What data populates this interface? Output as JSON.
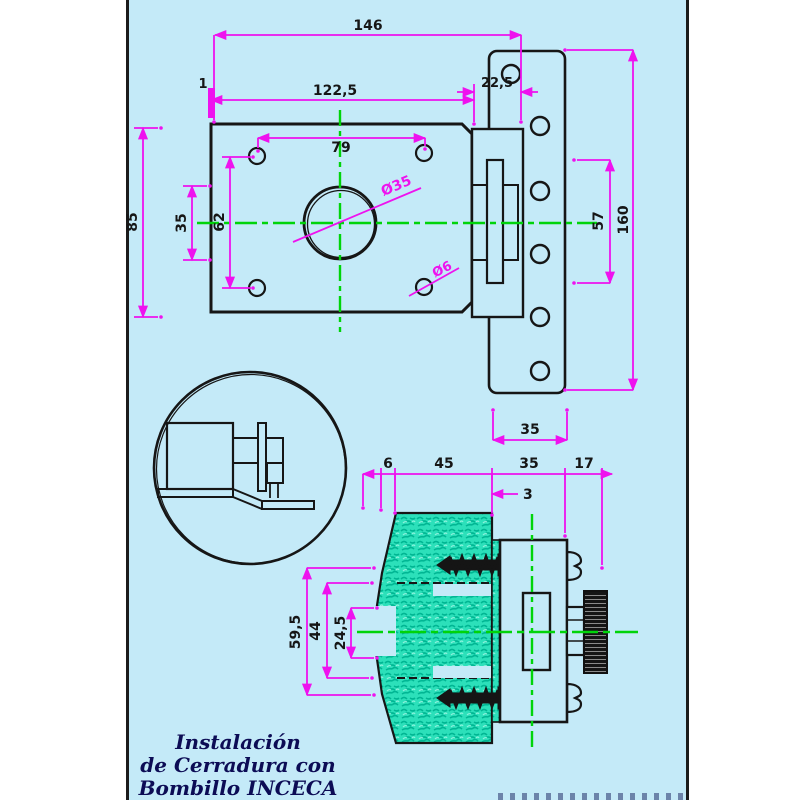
{
  "drawing": {
    "title": {
      "line1": "Instalación",
      "line2": "de Cerradura con",
      "line3": "Bombillo INCECA Plana"
    },
    "front_view": {
      "total_width": "146",
      "case_width": "122,5",
      "edge_gap": "1",
      "strike_overhang": "22,5",
      "screw_spacing_h": "79",
      "cylinder_dia": "Ø35",
      "screw_hole_dia": "Ø6",
      "case_height": "85",
      "center_height": "35",
      "screw_spacing_v": "62",
      "strike_height": "160",
      "strike_screw_span": "57",
      "strike_width": "35"
    },
    "section_view": {
      "lip": "6",
      "door_thickness": "45",
      "case_depth": "35",
      "knob_depth": "17",
      "clearance": "3",
      "cutout_height": "59,5",
      "case_height": "44",
      "bolt_height": "24,5"
    },
    "colors": {
      "background": "#c4eaf8",
      "outline": "#161616",
      "dimension": "#ee12ee",
      "centerline": "#00d40a",
      "hatch": "#2ce0ba",
      "title_text": "#0c0c55"
    }
  }
}
